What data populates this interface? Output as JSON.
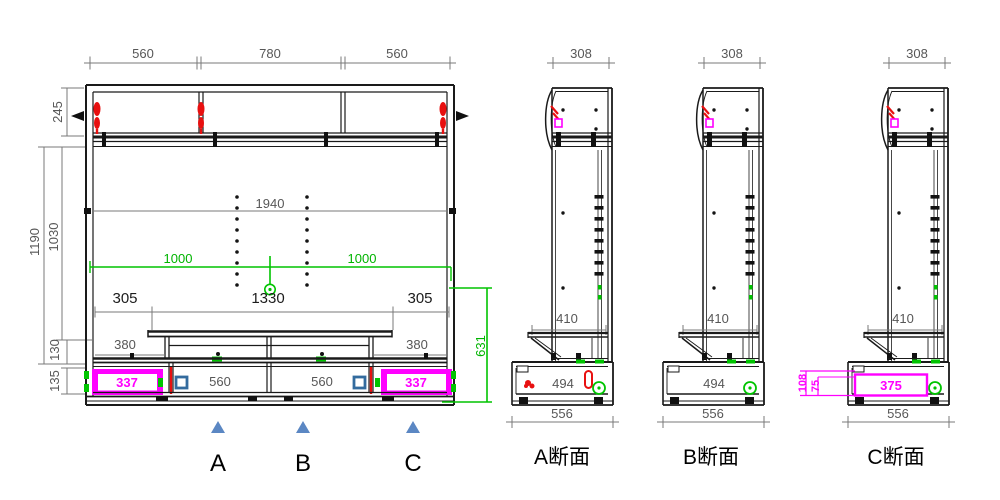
{
  "front_view": {
    "top_dims": [
      "560",
      "780",
      "560"
    ],
    "side_dims": [
      "245",
      "1190",
      "1030",
      "130",
      "135"
    ],
    "interior_width": "1940",
    "green_dims": {
      "left": "1000",
      "right": "1000",
      "height": "631"
    },
    "tv_dims": {
      "left": "305",
      "center": "1330",
      "right": "305"
    },
    "shelf_dims": {
      "left": "380",
      "right": "380"
    },
    "base_dims": {
      "drawer_left": "337",
      "bay_left": "560",
      "bay_right": "560",
      "drawer_right": "337"
    },
    "markers": [
      {
        "label": "A"
      },
      {
        "label": "B"
      },
      {
        "label": "C"
      }
    ]
  },
  "sections": [
    {
      "title": "A断面",
      "top_width": "308",
      "shelf_depth": "410",
      "base_depth_inner": "494",
      "base_depth": "556"
    },
    {
      "title": "B断面",
      "top_width": "308",
      "shelf_depth": "410",
      "base_depth_inner": "494",
      "base_depth": "556"
    },
    {
      "title": "C断面",
      "top_width": "308",
      "shelf_depth": "410",
      "drawer_width": "375",
      "drawer_height_dims": [
        "108",
        "75"
      ],
      "base_depth": "556"
    }
  ],
  "colors": {
    "line_black": "#1a1a1a",
    "dimension_gray": "#575757",
    "highlight_green": "#00c400",
    "highlight_magenta": "#ff00ff",
    "highlight_red": "#e81010",
    "marker_blue": "#5b87c3",
    "hardware_blue": "#336b9e"
  }
}
